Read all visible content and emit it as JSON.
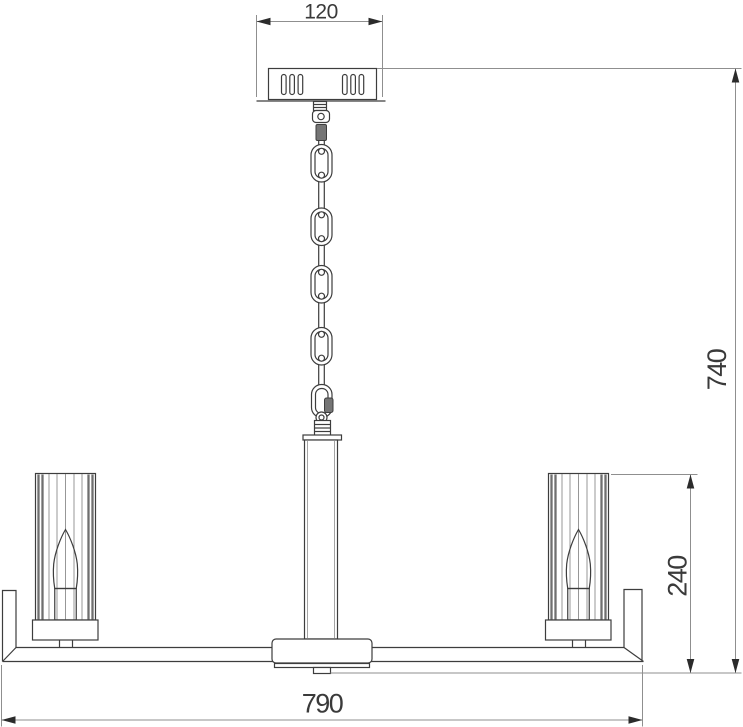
{
  "drawing": {
    "dimensions": {
      "canopy_width": "120",
      "overall_height": "740",
      "shade_height": "240",
      "overall_width": "790"
    },
    "colors": {
      "background": "#ffffff",
      "object_outline": "#3d3d3d",
      "dimension_lines": "#8f8f8f",
      "dimension_text": "#3a3a3a",
      "arrowheads": "#2b2b2b"
    }
  }
}
